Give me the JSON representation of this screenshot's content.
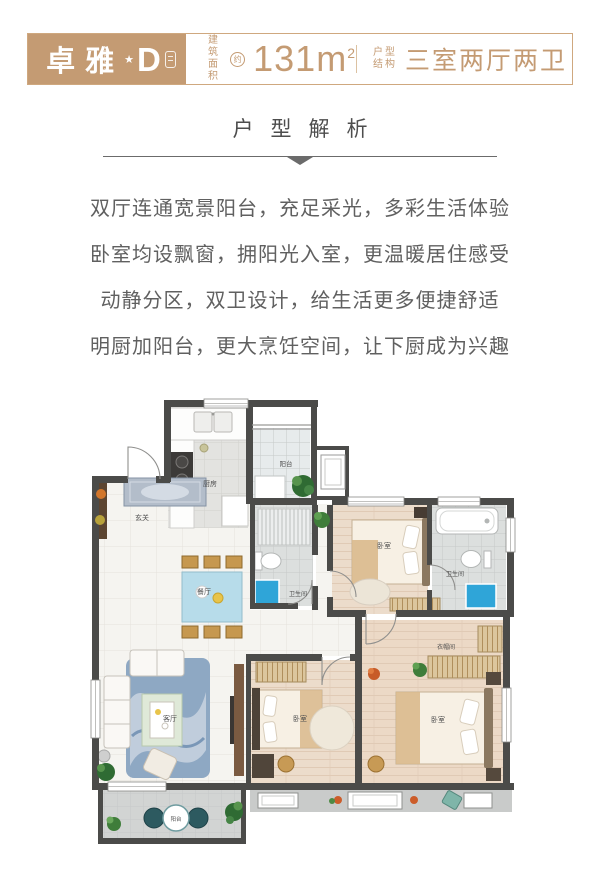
{
  "header": {
    "accent": "#c49b73",
    "logo": {
      "cn": "卓雅",
      "en": "ZHUOYA",
      "star": "★",
      "variant": "D"
    },
    "area": {
      "label1": "建筑",
      "label2": "面积",
      "approx": "约",
      "value": "131",
      "unit": "m",
      "power": "2"
    },
    "structure": {
      "label1": "户型",
      "label2": "结构",
      "value": "三室两厅两卫"
    }
  },
  "section": {
    "title": "户型解析"
  },
  "description": {
    "lines": [
      "双厅连通宽景阳台，充足采光，多彩生活体验",
      "卧室均设飘窗，拥阳光入室，更温暖居住感受",
      "动静分区，双卫设计，给生活更多便捷舒适",
      "明厨加阳台，更大烹饪空间，让下厨成为兴趣"
    ]
  },
  "floorplan": {
    "rooms": [
      {
        "id": "kitchen",
        "label": "厨房"
      },
      {
        "id": "balcony-top",
        "label": "阳台"
      },
      {
        "id": "foyer",
        "label": "玄关"
      },
      {
        "id": "dining",
        "label": "餐厅"
      },
      {
        "id": "bath-middle",
        "label": "卫生间"
      },
      {
        "id": "bedroom-top",
        "label": "卧室"
      },
      {
        "id": "bath-right",
        "label": "卫生间"
      },
      {
        "id": "living",
        "label": "客厅"
      },
      {
        "id": "bedroom-middle",
        "label": "卧室"
      },
      {
        "id": "bedroom-right",
        "label": "卧室"
      },
      {
        "id": "cloakroom",
        "label": "衣帽间"
      },
      {
        "id": "balcony-bottom",
        "label": "阳台"
      }
    ]
  }
}
